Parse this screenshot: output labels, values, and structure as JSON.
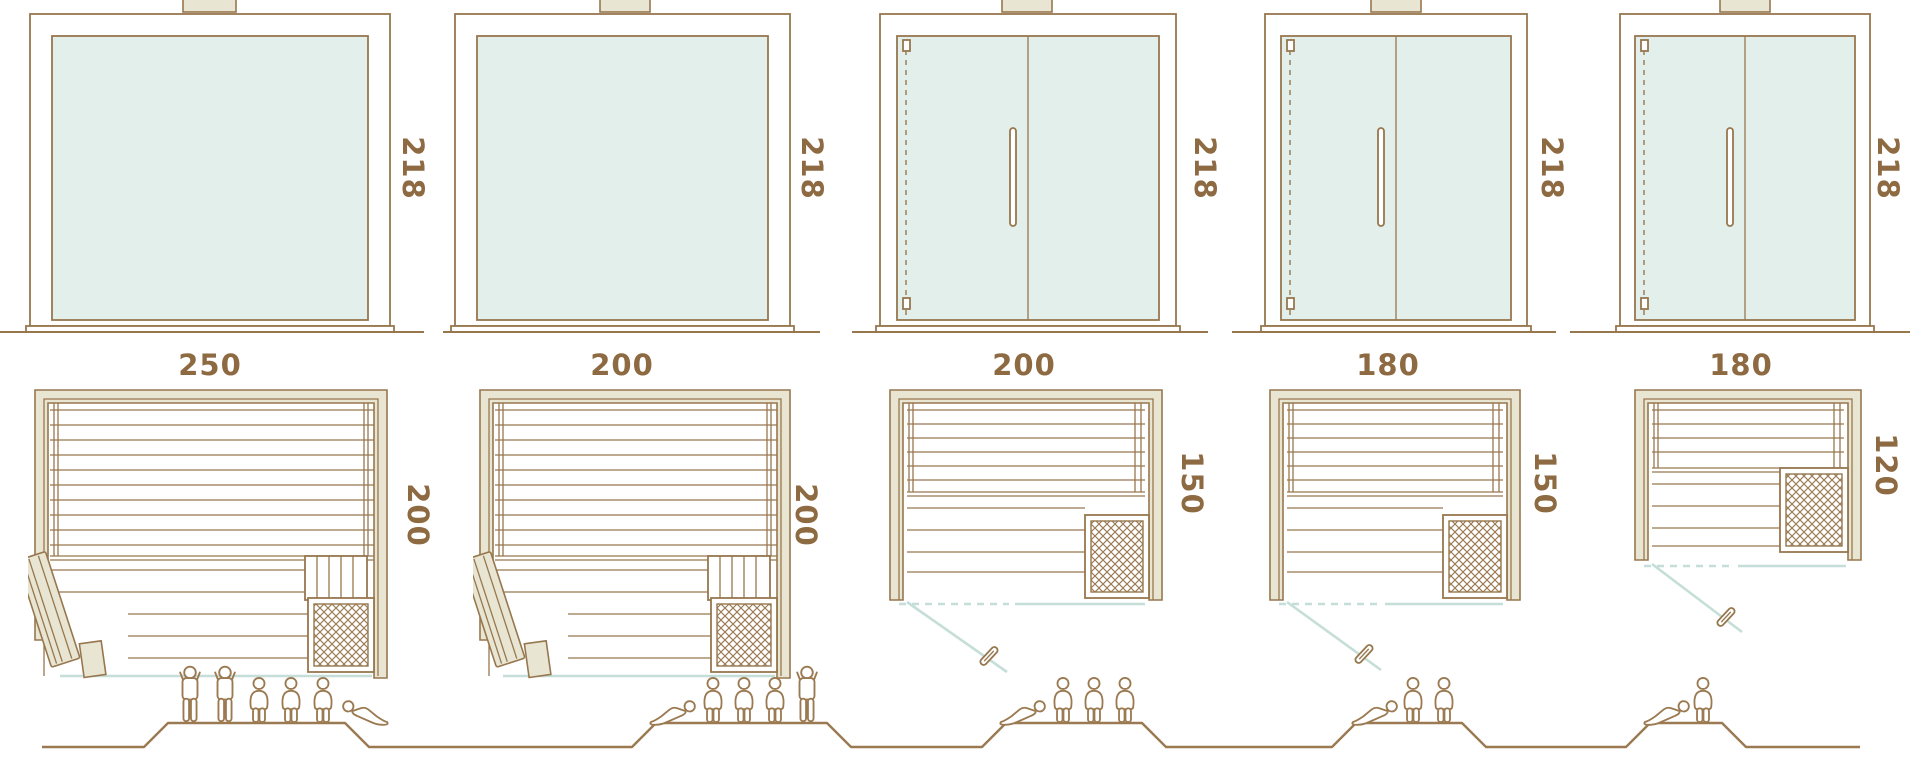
{
  "diagram": {
    "type": "sauna-size-comparison",
    "views": [
      "front-elevation",
      "floor-plan",
      "capacity-figures"
    ],
    "palette": {
      "line_brown": "#97774e",
      "label_brown": "#8d6a42",
      "wood_fill": "#e8e5d2",
      "glass_fill": "#e3efeb",
      "glass_line": "#c6ded8",
      "figure_line": "#9b7a52"
    },
    "saunas": [
      {
        "height": "218",
        "width": "250",
        "depth": "200",
        "capacity": {
          "standing": 2,
          "sitting": 3,
          "lying": 1,
          "total": 6
        },
        "front": "full-glass",
        "door": "hinged-wood-door-left",
        "heater": "front-right-corner"
      },
      {
        "height": "218",
        "width": "200",
        "depth": "200",
        "capacity": {
          "standing": 1,
          "sitting": 3,
          "lying": 1,
          "total": 5
        },
        "front": "full-glass",
        "door": "hinged-wood-door-left",
        "heater": "front-right-corner"
      },
      {
        "height": "218",
        "width": "200",
        "depth": "150",
        "capacity": {
          "standing": 0,
          "sitting": 3,
          "lying": 1,
          "total": 4
        },
        "front": "glass-with-hinged-door",
        "door": "glass-door-left",
        "heater": "front-right-corner"
      },
      {
        "height": "218",
        "width": "180",
        "depth": "150",
        "capacity": {
          "standing": 0,
          "sitting": 2,
          "lying": 1,
          "total": 3
        },
        "front": "glass-with-hinged-door",
        "door": "glass-door-left",
        "heater": "front-right-corner"
      },
      {
        "height": "218",
        "width": "180",
        "depth": "120",
        "capacity": {
          "standing": 0,
          "sitting": 1,
          "lying": 1,
          "total": 2
        },
        "front": "glass-with-hinged-door",
        "door": "glass-door-left",
        "heater": "right-side"
      }
    ]
  }
}
